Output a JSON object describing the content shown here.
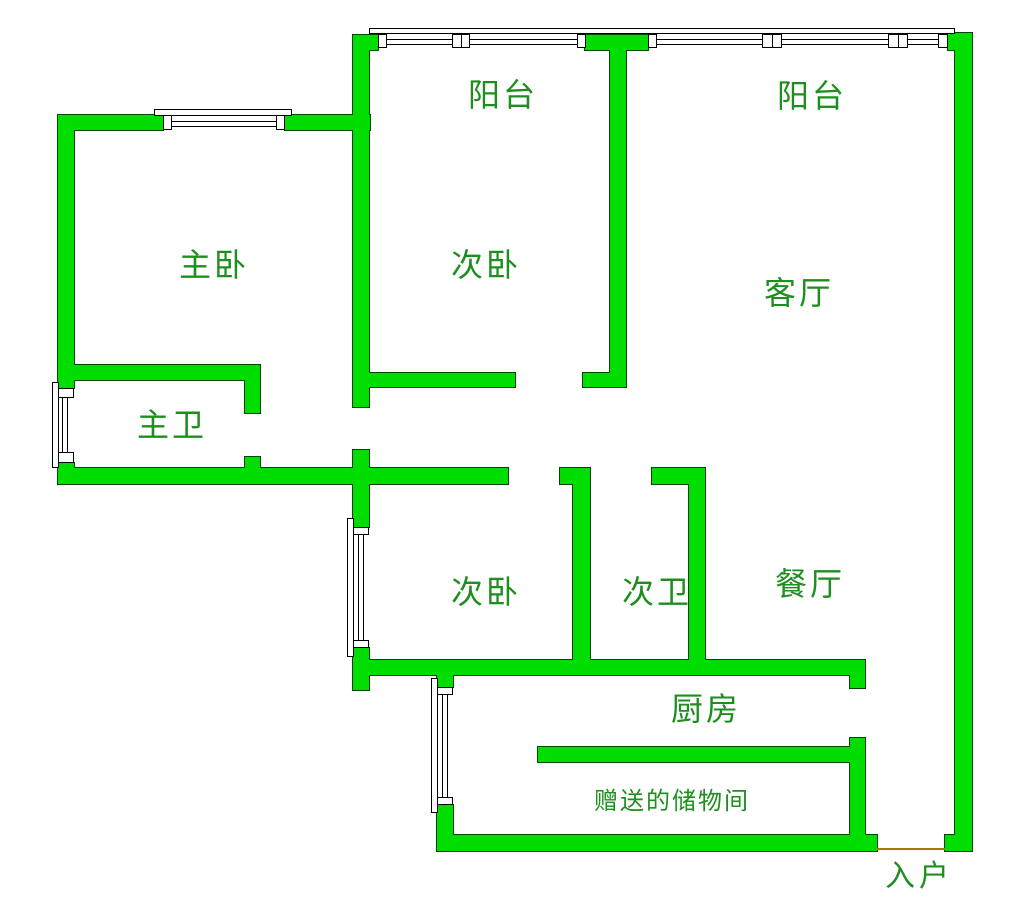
{
  "plan": {
    "type": "apartment-floor-plan",
    "language": "zh-CN"
  },
  "colors": {
    "background": "#ffffff",
    "wall_fill": "#00dd00",
    "wall_outline": "#004400",
    "window_outline": "#000000",
    "window_fill": "#ffffff",
    "label_text": "#1e8f1e",
    "threshold": "#a67c00"
  },
  "rooms": [
    {
      "id": "balcony-left",
      "label": "阳台"
    },
    {
      "id": "balcony-right",
      "label": "阳台"
    },
    {
      "id": "master-bedroom",
      "label": "主卧"
    },
    {
      "id": "second-bedroom-upper",
      "label": "次卧"
    },
    {
      "id": "living-room",
      "label": "客厅"
    },
    {
      "id": "master-bathroom",
      "label": "主卫"
    },
    {
      "id": "second-bedroom-lower",
      "label": "次卧"
    },
    {
      "id": "second-bathroom",
      "label": "次卫"
    },
    {
      "id": "dining-room",
      "label": "餐厅"
    },
    {
      "id": "kitchen",
      "label": "厨房"
    },
    {
      "id": "storage-room",
      "label": "赠送的储物间"
    },
    {
      "id": "entrance",
      "label": "入户"
    }
  ]
}
